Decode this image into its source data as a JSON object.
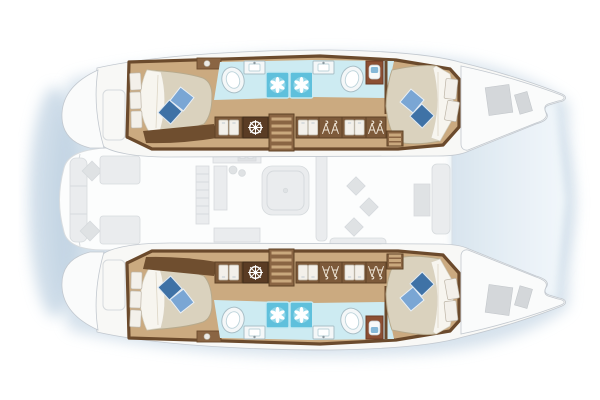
{
  "diagram": {
    "title": "Catamaran yacht interior floor plan (top-down)",
    "kind": "yacht-floorplan",
    "orientation": "bow-right",
    "hulls": [
      "starboard-top",
      "port-bottom"
    ],
    "rooms": [
      {
        "id": "aft-cabin-starboard",
        "type": "double-berth-cabin"
      },
      {
        "id": "aft-head-starboard",
        "type": "bathroom-shower"
      },
      {
        "id": "forward-head-starboard",
        "type": "bathroom-shower"
      },
      {
        "id": "forward-cabin-starboard",
        "type": "double-berth-cabin"
      },
      {
        "id": "aft-cabin-port",
        "type": "double-berth-cabin"
      },
      {
        "id": "aft-head-port",
        "type": "bathroom-shower"
      },
      {
        "id": "forward-head-port",
        "type": "bathroom-shower"
      },
      {
        "id": "forward-cabin-port",
        "type": "double-berth-cabin"
      },
      {
        "id": "saloon-galley",
        "type": "faded-main-deck"
      },
      {
        "id": "aft-cockpit",
        "type": "faded-main-deck"
      },
      {
        "id": "foredeck",
        "type": "faded-main-deck"
      }
    ],
    "icons": [
      "shower-drain-fan-icon",
      "ship-wheel-icon",
      "hanging-clothes-icon",
      "locker-door-icon",
      "oval-sink-icon",
      "basin-faucet-icon",
      "toilet-icon",
      "steps-icon"
    ]
  },
  "colors": {
    "background": "#ffffff",
    "shadow": "#cbdae7",
    "shadow_deep": "#bfd2e2",
    "hull_rim": "#f8f8f6",
    "hull_outline": "#c2c8cf",
    "deck_fill": "#fcfdfd",
    "deck_edge": "#d8dcdf",
    "bow_deck": "#fafbfb",
    "bow_shade_near": "#d9e5ef",
    "bow_shade_far": "#f4f9fc",
    "faded_fill": "#eaecee",
    "faded_dark": "#dfe2e4",
    "faded_stroke": "#d6dadd",
    "gray_hatch": "#d4d7da",
    "wood_floor": "#cbaa80",
    "wall_dark": "#6b4a2c",
    "locker_brown": "#7d5a3a",
    "locker_edge": "#5f4226",
    "wheel_box": "#5a3c24",
    "step_dark": "#8a6543",
    "step_stripe": "#c9a87d",
    "mattress": "#dad2be",
    "mattress_edge": "#b7aa8d",
    "sheet": "#f7f5ef",
    "sheet_edge": "#d9d2c1",
    "pillow_light": "#7aa6d4",
    "pillow_dark": "#3f72a6",
    "bath_floor": "#cdebf2",
    "shower_tile": "#5fc0dc",
    "fixture_white": "#f4f7f8",
    "toilet_box": "#8c4f33",
    "toilet_lid": "#86b8d8",
    "hanger_tan": "#f0e7d8"
  }
}
